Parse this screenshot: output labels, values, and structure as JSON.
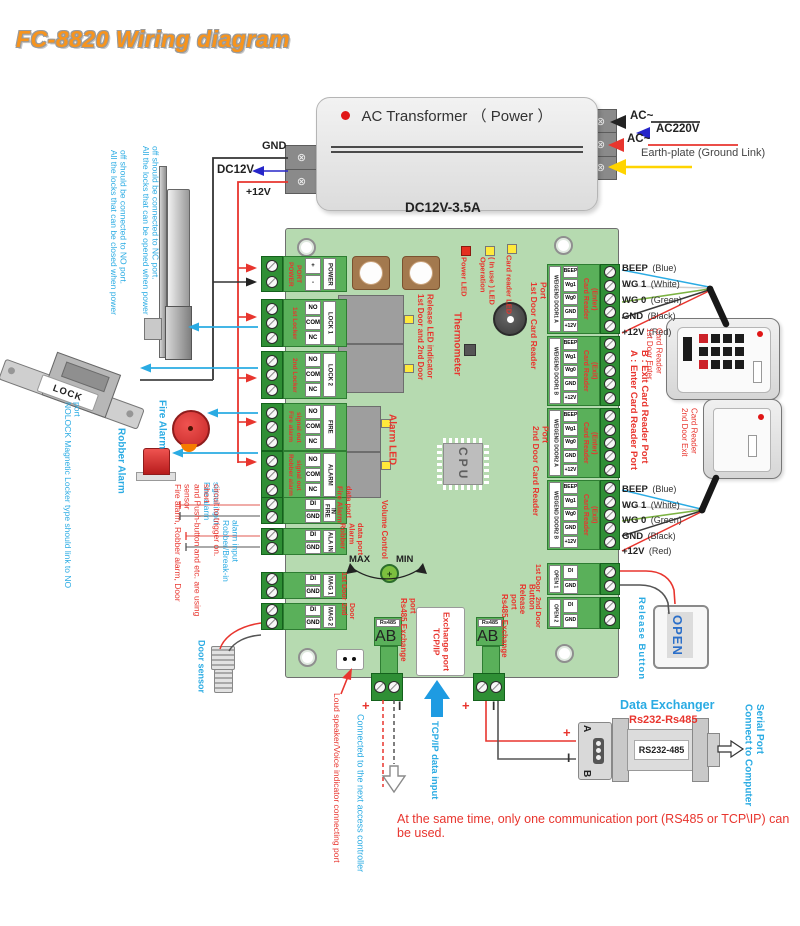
{
  "title": "FC-8820 Wiring diagram",
  "colors": {
    "accent_red": "#e8352e",
    "accent_blue": "#2aabe3",
    "title_orange": "#f7941d",
    "board_green": "#b6dab0",
    "terminal_green": "#5ab05a",
    "wire_yellow": "#ffd400"
  },
  "transformer": {
    "label": "AC Transformer （ Power ）",
    "rating": "DC12V-3.5A",
    "ac_in_1": "AC~",
    "ac_in_2": "AC~",
    "ac220": "AC220V",
    "earth": "Earth-plate (Ground Link)",
    "gnd": "GND",
    "dc12v": "DC12V",
    "p12v": "+12V"
  },
  "board": {
    "leds": {
      "power": "Power LED",
      "operation": "Operation\n( In use ) LED",
      "card": "Card reader LED"
    },
    "labels": {
      "release_led": "1st Door and 2nd Door\nRelease LED indicator",
      "thermometer": "Thermometer",
      "reader1_port": "1st Door Card Reader Port",
      "reader2_port": "2nd Door Card Reader Port",
      "alarm_led": "Alarm LED",
      "fire_data": "Fire Alarm\ndata port",
      "robber_data": "Robber Alarm\ndata port",
      "volume": "Volume Control",
      "max": "MAX",
      "min": "MIN",
      "cpu": "CPU",
      "rs485_a": "Rs485 Exchange port",
      "rs485_b": "Rs485 Exchange port",
      "tcpip": "TCP/IP\nExchange port",
      "release_button": "Release Button",
      "open1": "1st Door",
      "open2": "2nd Door",
      "mag1": "1st Door",
      "mag2": "2nd Door",
      "rs485_hdr": "Rs485"
    },
    "lt": [
      {
        "label": "POWER\nPORT",
        "pins": [
          "+",
          "-"
        ],
        "name": "POWER"
      },
      {
        "label": "1st Locker",
        "pins": [
          "NO",
          "COM",
          "NC"
        ],
        "name": "LOCK 1"
      },
      {
        "label": "2nd Locker",
        "pins": [
          "NO",
          "COM",
          "NC"
        ],
        "name": "LOCK 2"
      },
      {
        "label": "Fire alarm\nsignal out",
        "pins": [
          "NO",
          "COM",
          "NC"
        ],
        "name": "FIRE"
      },
      {
        "label": "Robber alarm\nsignal out",
        "pins": [
          "NO",
          "COM",
          "NC"
        ],
        "name": "ALARM"
      },
      {
        "label": "",
        "pins": [
          "DI",
          "GND"
        ],
        "name": "FIRE IN"
      },
      {
        "label": "",
        "pins": [
          "DI",
          "GND"
        ],
        "name": "ALA IN"
      },
      {
        "label": "",
        "pins": [
          "DI",
          "GND"
        ],
        "name": "MAG 1"
      },
      {
        "label": "",
        "pins": [
          "DI",
          "GND"
        ],
        "name": "MAG 2"
      }
    ],
    "rt": [
      {
        "name": "WEIGEND DOOR1 A",
        "pins": [
          "BEEP",
          "Wg1",
          "Wg0",
          "GND",
          "+12V"
        ],
        "label": "Card Reader\n(Enter)"
      },
      {
        "name": "WEIGEND DOOR1 B",
        "pins": [
          "BEEP",
          "Wg1",
          "Wg0",
          "GND",
          "+12V"
        ],
        "label": "Card Reader\n(Exit)"
      },
      {
        "name": "WEIGEND DOOR2 A",
        "pins": [
          "BEEP",
          "Wg1",
          "Wg0",
          "GND",
          "+12V"
        ],
        "label": "Card Reader\n(Enter)"
      },
      {
        "name": "WEIGEND DOOR2 B",
        "pins": [
          "BEEP",
          "Wg1",
          "Wg0",
          "GND",
          "+12V"
        ],
        "label": "Card Reader\n(Exit)"
      },
      {
        "name": "OPEN 1",
        "pins": [
          "DI",
          "GND"
        ],
        "label": ""
      },
      {
        "name": "OPEN 2",
        "pins": [
          "DI",
          "GND"
        ],
        "label": ""
      }
    ],
    "rs485_pins": [
      "A",
      "B"
    ]
  },
  "wire_legend": [
    {
      "n": "BEEP",
      "c": "(Blue)"
    },
    {
      "n": "WG 1",
      "c": "(White)"
    },
    {
      "n": "WG 0",
      "c": "(Green)"
    },
    {
      "n": "GND",
      "c": "(Black)"
    },
    {
      "n": "+12V",
      "c": "(Red)"
    }
  ],
  "readers": {
    "r1": "1st Door Enter\nCard Reader",
    "r2": "2nd Door Exit\nCard Reader",
    "ab": "A : Enter Card Reader Port\nB : Exit Card Reader Port"
  },
  "release": {
    "label": "Release Button",
    "open": "OPEN"
  },
  "exchanger": {
    "title": "Data Exchanger",
    "subtitle": "Rs232-Rs485",
    "device": "RS232-485",
    "a": "A",
    "b": "B",
    "plus": "+",
    "bar": "I",
    "connect": "Connect to Computer\nSerial Port"
  },
  "devices": {
    "lock": "LOCK"
  },
  "notes": {
    "nc": "All the locks that can be opened when  power\noff should be connected to NC port.",
    "no": "All the locks that can be closed when power\noff should be connected to NO port.",
    "nolock": "NOLOCK Magnetic Locker type should link to NO port",
    "fire_alarm": "Fire Alarm",
    "robber_alarm": "Robber Alarm",
    "fire_in": "Fire alarm\nsignal input",
    "robber_in": "Robber/Break-in\nalarm input",
    "short": "Fire alarm, Robber alarm, Door sensor\nand Push-button and etc. are using short\ncircuit to trigger on.",
    "door_sensor": "Door sensor",
    "speaker": "Loud speaker/Voice indicator connecting port",
    "next": "Connected to the next access controller",
    "tcp_in": "TCP/IP data input",
    "same_time": "At the same time, only one communication port (RS485 or TCP\\IP) can be used.",
    "plus_l": "+",
    "bar_l": "I",
    "plus_r": "+",
    "bar_r": "I"
  }
}
